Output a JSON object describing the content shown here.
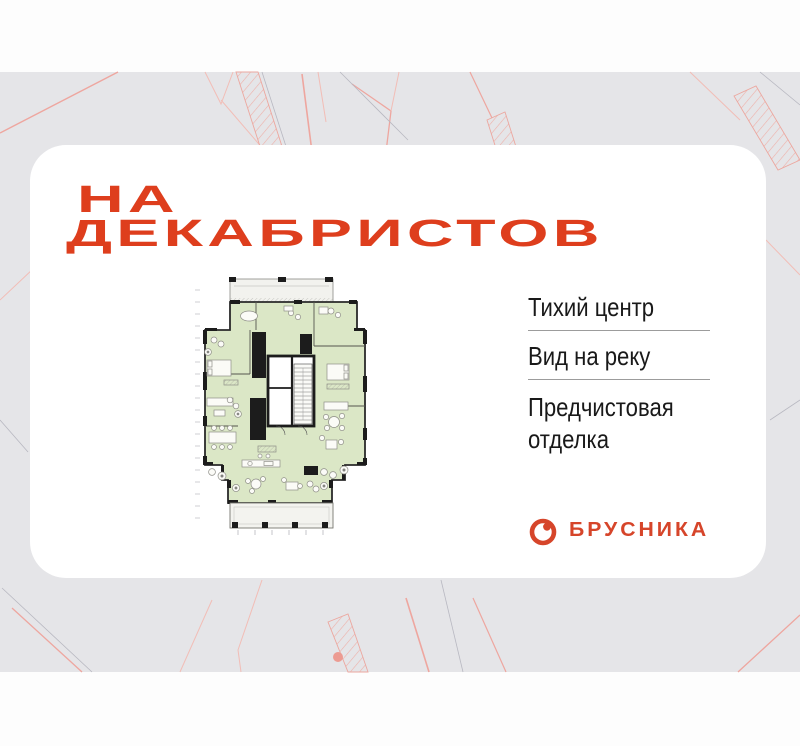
{
  "title": {
    "line1": "НА",
    "line2": "ДЕКАБРИСТОВ"
  },
  "features": {
    "items": [
      {
        "label": "Тихий центр"
      },
      {
        "label": "Вид на реку"
      },
      {
        "label": "Предчистовая отделка"
      }
    ]
  },
  "logo": {
    "text": "БРУСНИКА",
    "icon": "brusnika-berry-icon"
  },
  "floorplan": {
    "icon": "apartment-floor-plan"
  },
  "colors": {
    "accent_red": "#de3e1d",
    "logo_red": "#d6452a",
    "card_white": "#ffffff",
    "background_gray": "#e5e5e8",
    "band_white": "#fdfdfd",
    "siteplan_pink": "#eea69f",
    "plan_room_green": "#dbe7c6",
    "plan_wall_black": "#1c1c1c",
    "feature_text": "#191919",
    "divider_gray": "#9c9c9c"
  }
}
